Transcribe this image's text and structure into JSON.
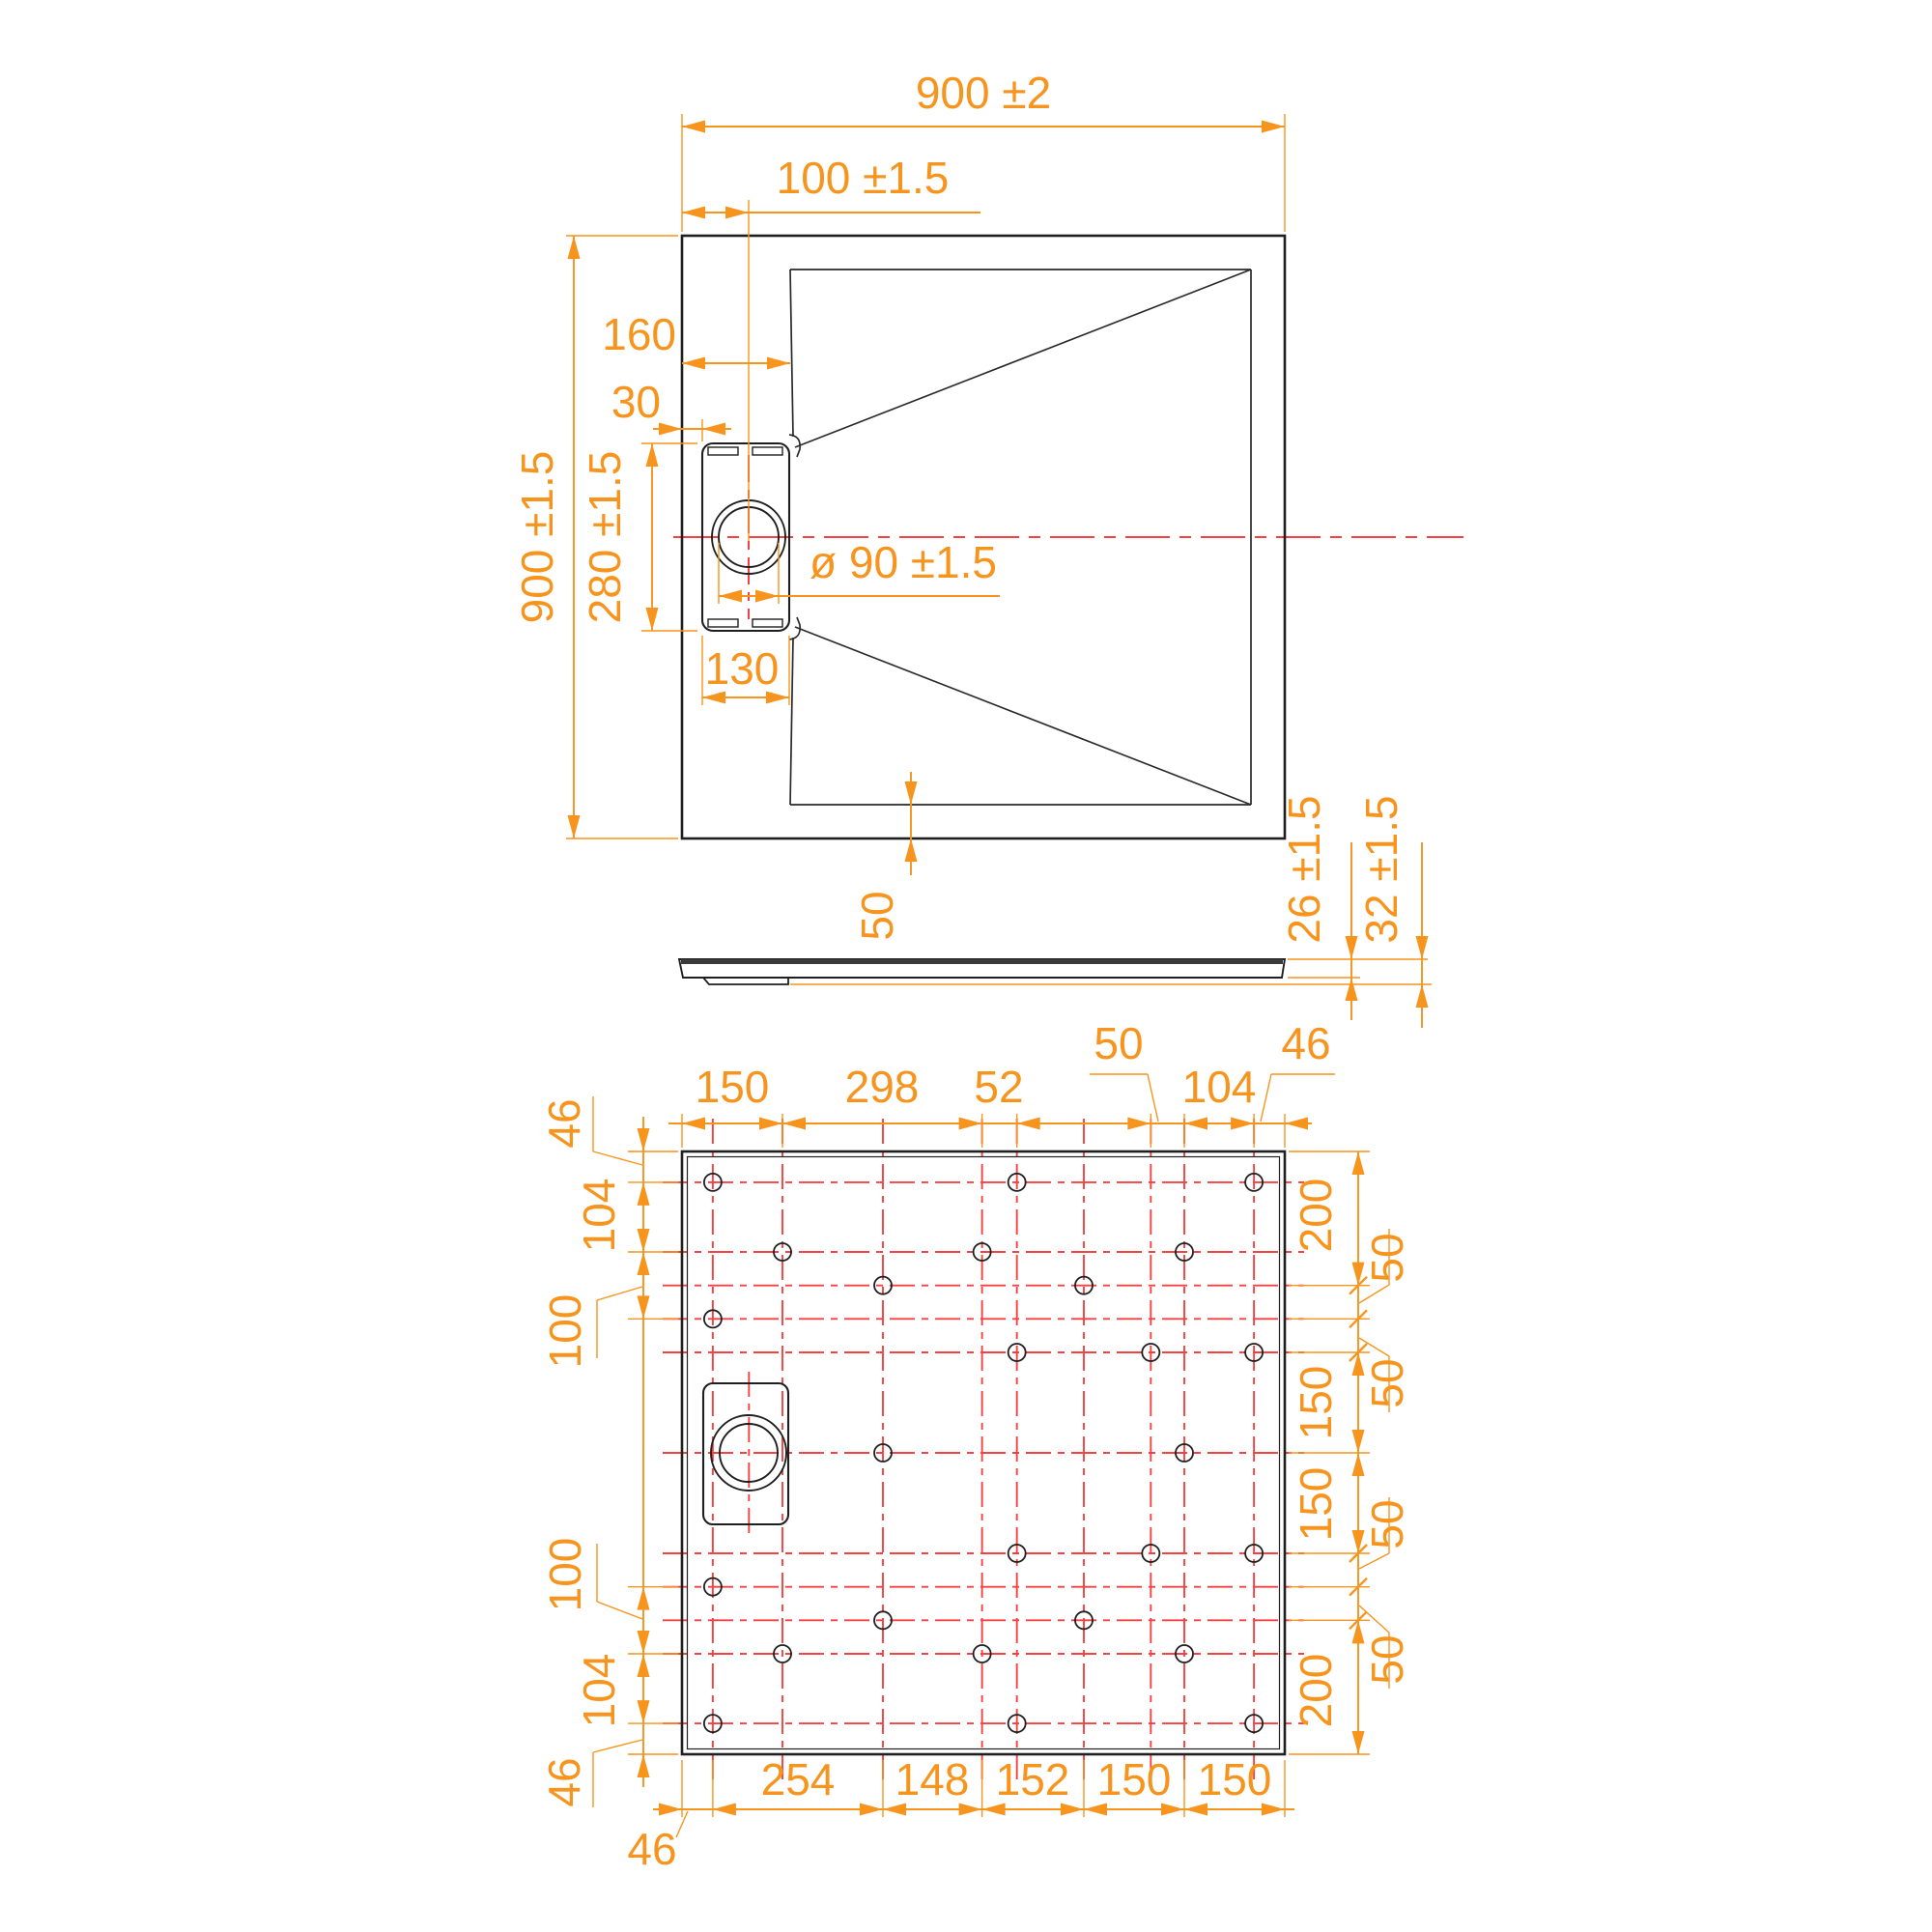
{
  "drawing": {
    "kind": "shower-tray technical drawing, three orthographic views",
    "colors": {
      "dimension": "#F7941D",
      "centerline": "#F44242",
      "outline": "#1f1f1f",
      "background": "#ffffff"
    }
  },
  "plan": {
    "labels": {
      "overall_width": "900 ±2",
      "drain_offset": "100 ±1.5",
      "basin_inset_left": "160",
      "box_offset_left": "30",
      "overall_height": "900 ±1.5",
      "box_height": "280 ±1.5",
      "drain_diameter": "ø 90 ±1.5",
      "box_width": "130",
      "border_width": "50"
    }
  },
  "side": {
    "labels": {
      "shell_thickness": "26 ±1.5",
      "total_height": "32 ±1.5"
    }
  },
  "bottom": {
    "top_chain": [
      "150",
      "298",
      "52",
      "50",
      "104",
      "46"
    ],
    "bottom_chain": [
      "46",
      "254",
      "148",
      "152",
      "150",
      "150"
    ],
    "left_chain": [
      "46",
      "104",
      "100",
      "100",
      "104",
      "46"
    ],
    "right_chain": [
      "200",
      "50",
      "50",
      "150",
      "150",
      "50",
      "50",
      "200"
    ],
    "square_mm": 900,
    "grid_columns_mm": [
      46,
      150,
      300,
      448,
      500,
      600,
      700,
      750,
      854
    ],
    "grid_rows_mm": [
      46,
      150,
      200,
      250,
      300,
      450,
      600,
      650,
      700,
      750,
      854
    ],
    "hole_radius_mm": 13,
    "holes_mm": [
      [
        46,
        46
      ],
      [
        500,
        46
      ],
      [
        854,
        46
      ],
      [
        150,
        150
      ],
      [
        448,
        150
      ],
      [
        750,
        150
      ],
      [
        300,
        200
      ],
      [
        600,
        200
      ],
      [
        46,
        250
      ],
      [
        500,
        300
      ],
      [
        700,
        300
      ],
      [
        854,
        300
      ],
      [
        300,
        450
      ],
      [
        750,
        450
      ],
      [
        500,
        600
      ],
      [
        700,
        600
      ],
      [
        854,
        600
      ],
      [
        46,
        650
      ],
      [
        300,
        700
      ],
      [
        600,
        700
      ],
      [
        150,
        750
      ],
      [
        448,
        750
      ],
      [
        750,
        750
      ],
      [
        46,
        854
      ],
      [
        500,
        854
      ],
      [
        854,
        854
      ]
    ],
    "drain_center_mm": [
      100,
      450
    ]
  }
}
